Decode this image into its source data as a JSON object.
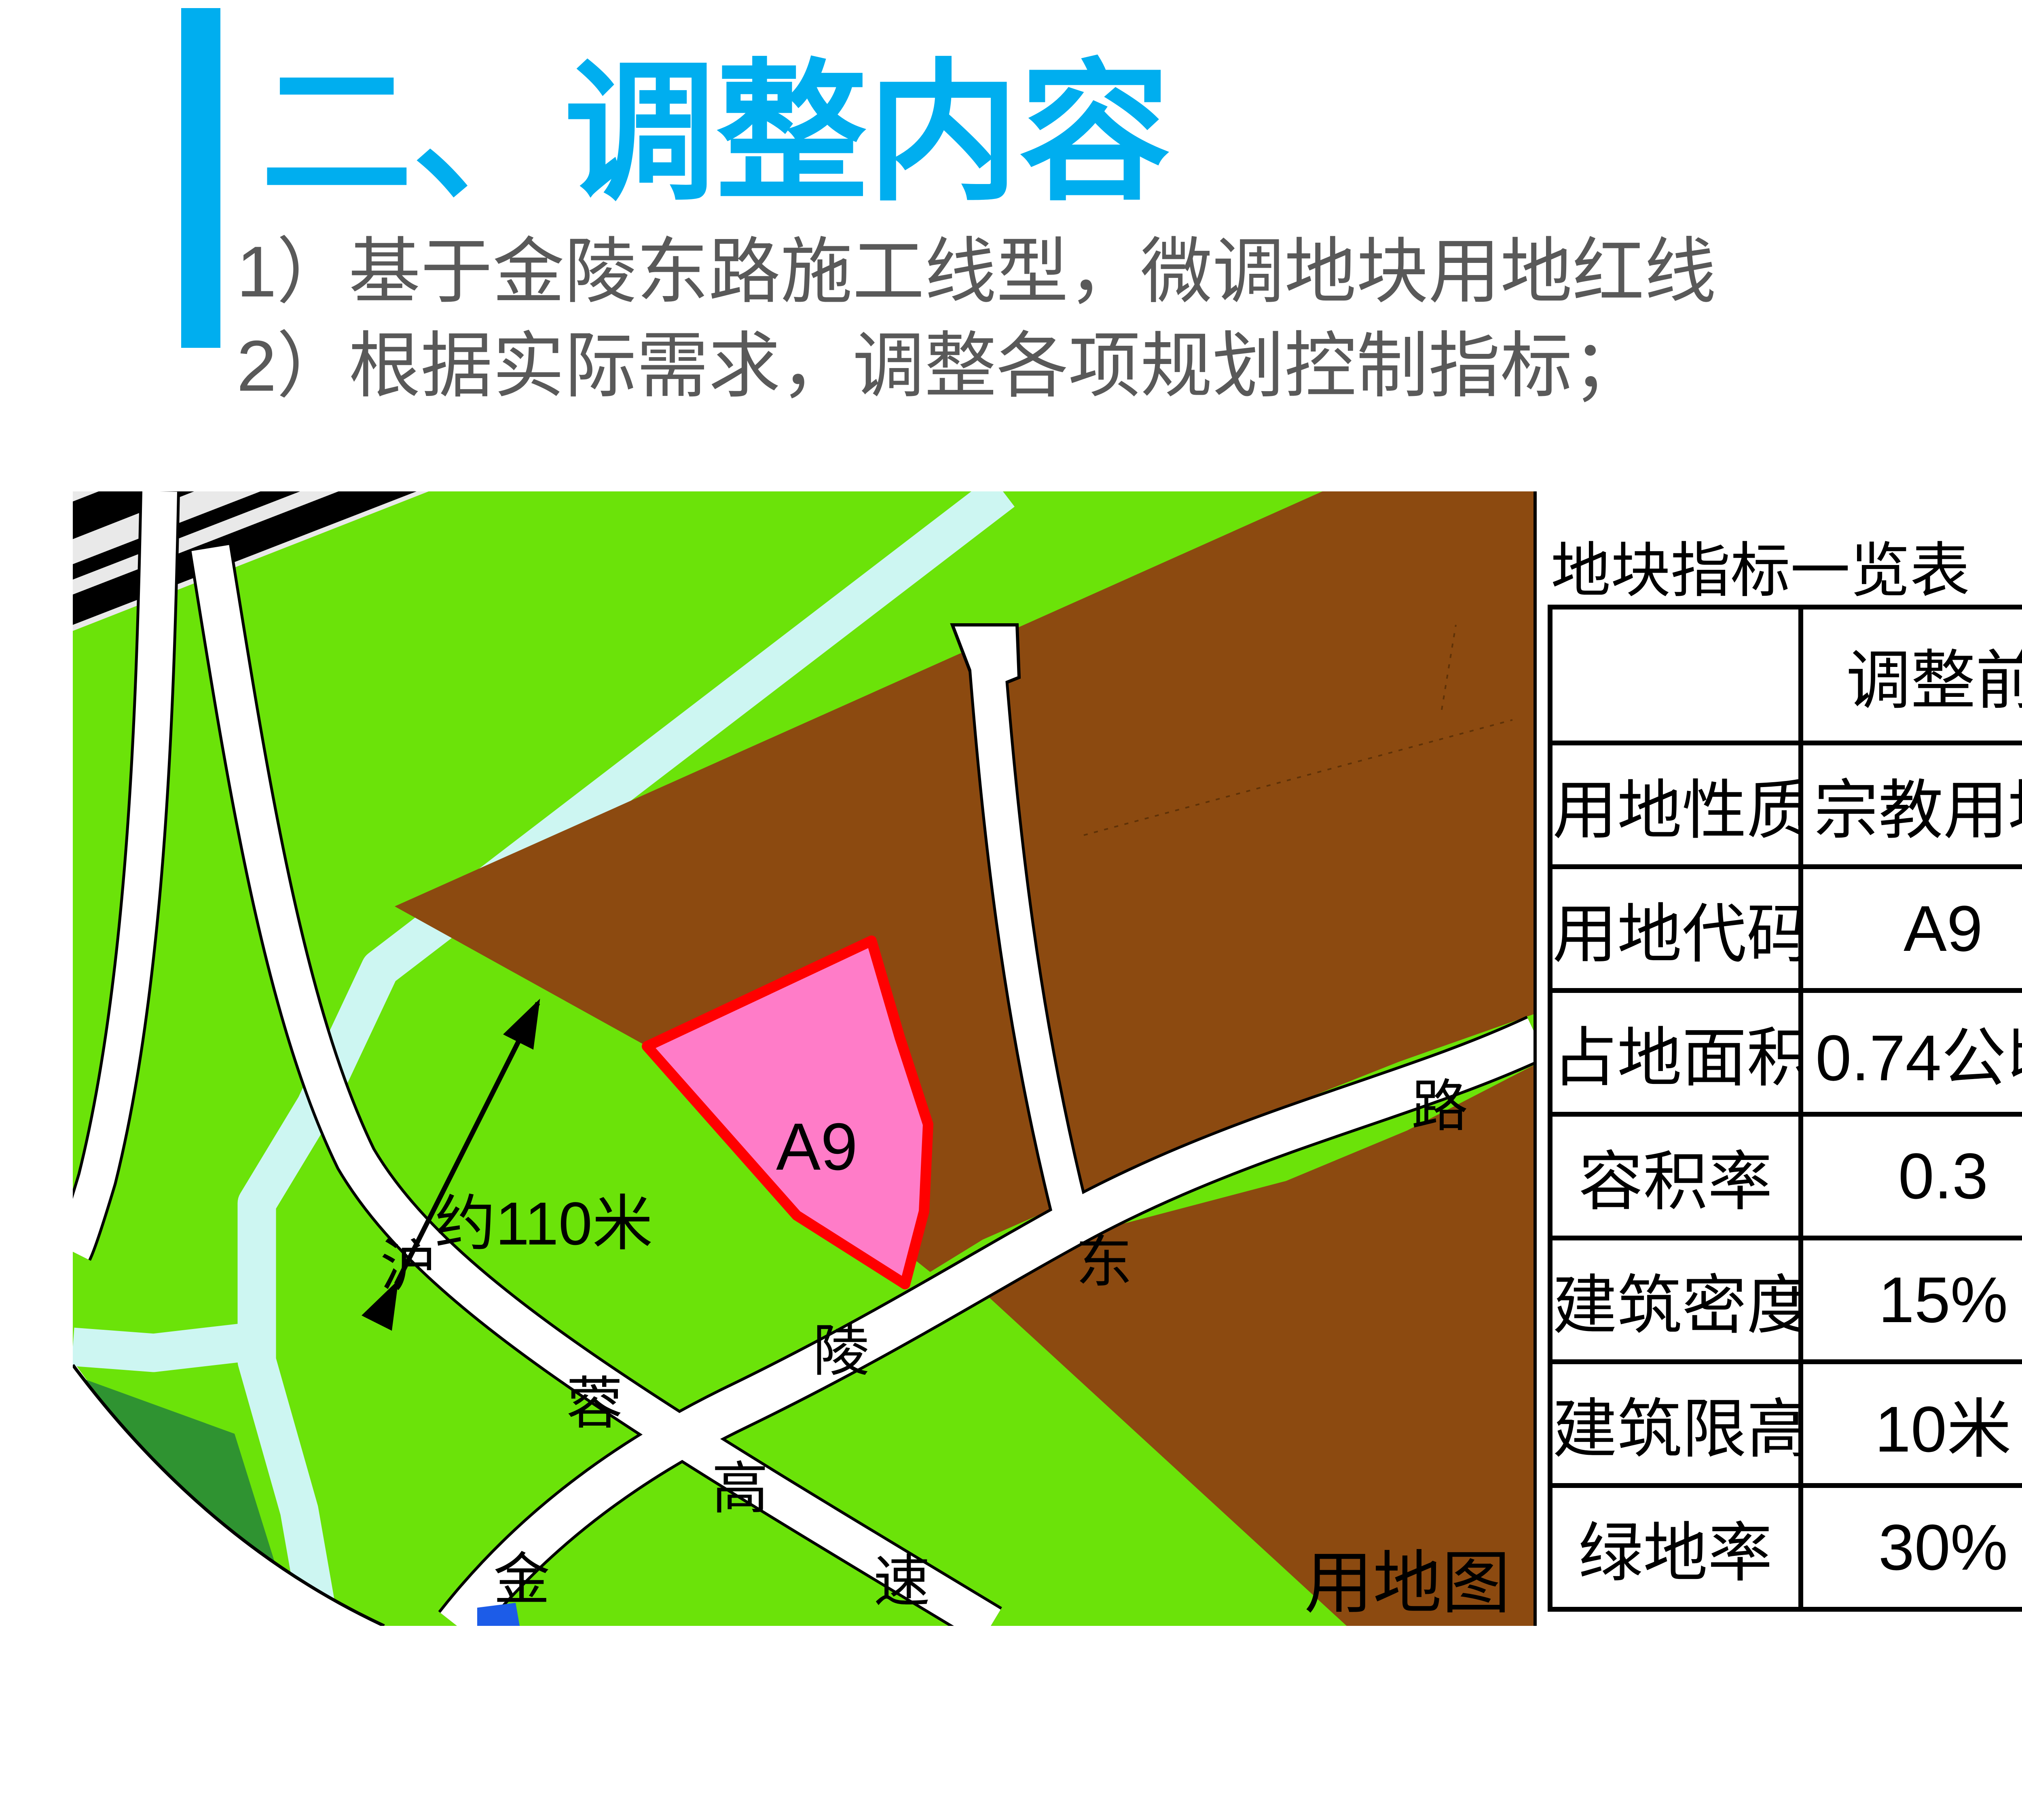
{
  "title": {
    "text": "二、调整内容",
    "color": "#00AEEF"
  },
  "bullets": [
    {
      "text": "1）基于金陵东路施工线型，微调地块用地红线"
    },
    {
      "text": "2）根据实际需求，调整各项规划控制指标；"
    }
  ],
  "map": {
    "caption": "用地图",
    "parcel_label": "A9",
    "dimension_label": "约110米",
    "road_labels": [
      "沪",
      "蓉",
      "高",
      "速",
      "金",
      "陵",
      "东",
      "路"
    ],
    "colors": {
      "grass_green": "#6BE309",
      "dark_green": "#2F9331",
      "river_cyan": "#CDF6F2",
      "land_brown": "#8C4A10",
      "parcel_pink": "#FF7CC8",
      "parcel_border_red": "#FF0000",
      "railway_gray": "#E9E9E9",
      "water_blue": "#1C5CE8"
    }
  },
  "table": {
    "title": "地块指标一览表",
    "columns": [
      "",
      "调整前",
      "调整后"
    ],
    "rows": [
      {
        "label": "用地性质",
        "before": "宗教用地",
        "after": "宗教用地",
        "changed": false
      },
      {
        "label": "用地代码",
        "before": "A9",
        "after": "A9",
        "changed": false
      },
      {
        "label": "占地面积",
        "before": "0.74公顷",
        "after": "0.73公顷",
        "changed": true
      },
      {
        "label": "容积率",
        "before": "0.3",
        "after": "0.4",
        "changed": true
      },
      {
        "label": "建筑密度",
        "before": "15%",
        "after": "25%",
        "changed": true
      },
      {
        "label": "建筑限高",
        "before": "10米",
        "after": "15米",
        "changed": true
      },
      {
        "label": "绿地率",
        "before": "30%",
        "after": "25%",
        "changed": true
      }
    ],
    "changed_color": "#FF0000"
  }
}
